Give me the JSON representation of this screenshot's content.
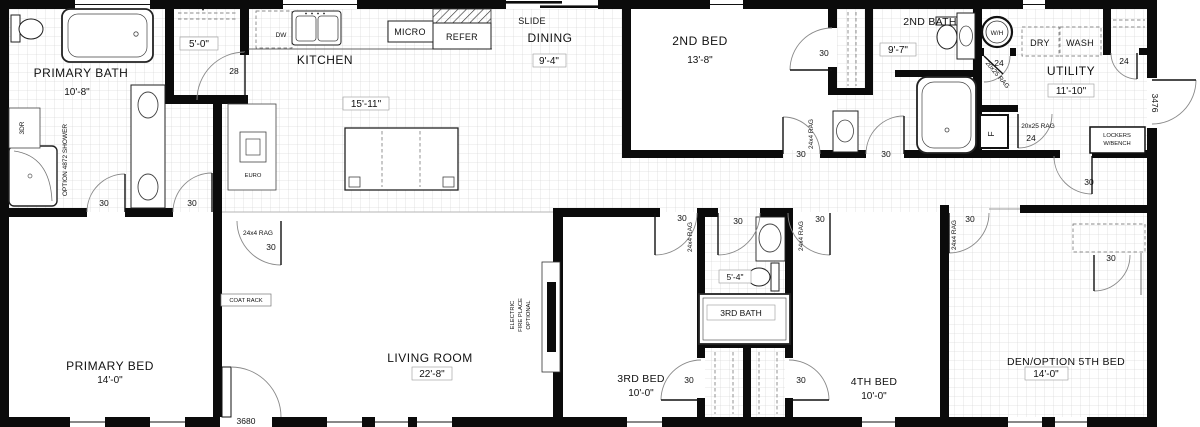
{
  "plan": {
    "rooms": {
      "primary_bath": {
        "name": "PRIMARY BATH",
        "dim": "10'-8\""
      },
      "primary_closet": {
        "dim": "5'-0\""
      },
      "kitchen": {
        "name": "KITCHEN",
        "dim": "15'-11\""
      },
      "dining": {
        "name": "DINING",
        "dim": "9'-4\""
      },
      "second_bed": {
        "name": "2ND BED",
        "dim": "13'-8\""
      },
      "second_bath": {
        "name": "2ND BATH",
        "dim": "9'-7\""
      },
      "utility": {
        "name": "UTILITY",
        "dim": "11'-10\""
      },
      "primary_bed": {
        "name": "PRIMARY BED",
        "dim": "14'-0\""
      },
      "living_room": {
        "name": "LIVING ROOM",
        "dim": "22'-8\""
      },
      "third_bed": {
        "name": "3RD BED",
        "dim": "10'-0\""
      },
      "third_bath": {
        "name": "3RD BATH",
        "dim": "5'-4\""
      },
      "fourth_bed": {
        "name": "4TH BED",
        "dim": "10'-0\""
      },
      "den": {
        "name": "DEN/OPTION 5TH BED",
        "dim": "14'-0\""
      }
    },
    "appliances": {
      "dw": "DW",
      "micro": "MICRO",
      "refer": "REFER",
      "slide": "SLIDE",
      "wh": "W/H",
      "dry": "DRY",
      "wash": "WASH",
      "furnace": "F",
      "euro": "EURO"
    },
    "features": {
      "shower_option": "OPTION 4872 SHOWER",
      "door_3dr": "3DR",
      "coat_rack": "COAT RACK",
      "lockers_line1": "LOCKERS",
      "lockers_line2": "W/BENCH",
      "fireplace_line1": "ELECTRIC",
      "fireplace_line2": "FIRE PLACE",
      "fireplace_line3": "OPTIONAL"
    },
    "door_sizes": {
      "d24": "24",
      "d28": "28",
      "d30": "30",
      "d3476": "3476",
      "d3680": "3680"
    },
    "floor_notes": {
      "rag_24x4": "24x4 RAG",
      "rag_20x25": "20x25 RAG"
    }
  }
}
